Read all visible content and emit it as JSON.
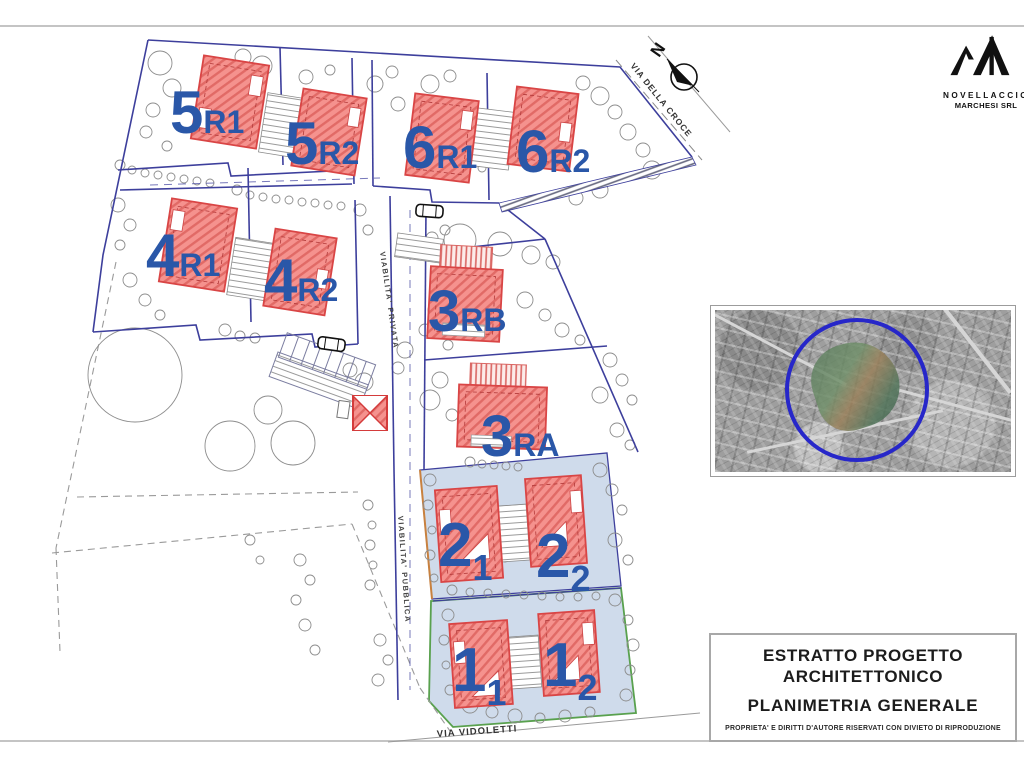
{
  "plan": {
    "compass_north": "N",
    "streets": {
      "croce": "VIA DELLA CROCE",
      "vidoletti": "VIA VIDOLETTI",
      "privata": "VIABILITA' PRIVATA",
      "pubblica": "VIABILITA' PUBBLICA"
    },
    "lots": [
      {
        "main": "5",
        "suffix": "R1"
      },
      {
        "main": "5",
        "suffix": "R2"
      },
      {
        "main": "6",
        "suffix": "R1"
      },
      {
        "main": "6",
        "suffix": "R2"
      },
      {
        "main": "4",
        "suffix": "R1"
      },
      {
        "main": "4",
        "suffix": "R2"
      },
      {
        "main": "3",
        "suffix": "RB"
      },
      {
        "main": "3",
        "suffix": "RA"
      },
      {
        "main": "2",
        "suffix": "1"
      },
      {
        "main": "2",
        "suffix": "2"
      },
      {
        "main": "1",
        "suffix": "1"
      },
      {
        "main": "1",
        "suffix": "2"
      }
    ]
  },
  "brand": {
    "line1": "NOVELLACCIO",
    "line2": "MARCHESI SRL"
  },
  "title_block": {
    "line1": "ESTRATTO PROGETTO",
    "line2": "ARCHITETTONICO",
    "line3": "PLANIMETRIA GENERALE",
    "disclaimer": "PROPRIETA' E DIRITTI D'AUTORE RISERVATI CON DIVIETO DI RIPRODUZIONE"
  },
  "colors": {
    "label_blue": "#2a57a8",
    "building_fill": "#f5928e",
    "building_stroke": "#d94545",
    "boundary_navy": "#3d3f9c",
    "zone_fill": "#cfdbeb",
    "zone1_green": "#59a14e",
    "zone2_orange": "#c8813f"
  }
}
